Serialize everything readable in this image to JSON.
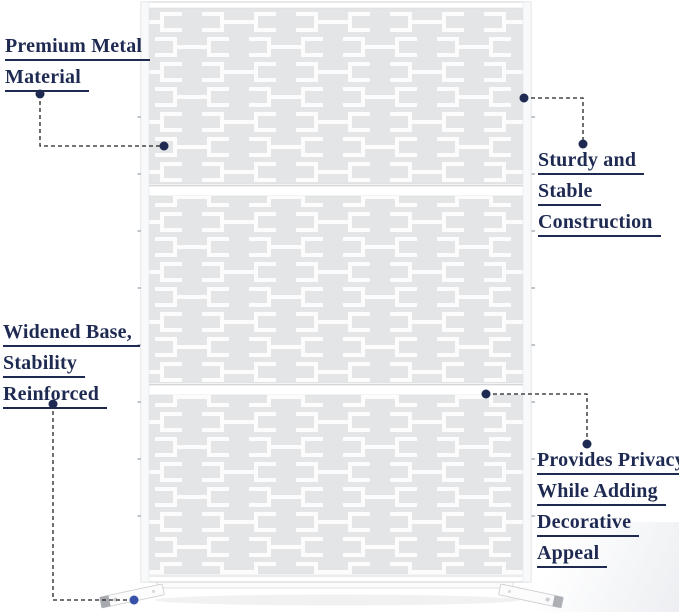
{
  "figure": {
    "subject": "white decorative metal privacy screen with laser-cut bracket pattern, three panels, widened feet",
    "panel_count": "3"
  },
  "callouts": [
    {
      "id": "premium-metal",
      "lines": [
        "Premium Metal",
        "Material"
      ]
    },
    {
      "id": "sturdy",
      "lines": [
        "Sturdy and",
        "Stable",
        "Construction"
      ]
    },
    {
      "id": "widened-base",
      "lines": [
        "Widened Base,",
        "Stability",
        "Reinforced"
      ]
    },
    {
      "id": "privacy-appeal",
      "lines": [
        "Provides Privacy",
        "While Adding",
        "Decorative",
        "Appeal"
      ]
    }
  ],
  "colors": {
    "label_text": "#1e2a52",
    "underline": "#1e2a52",
    "connector_line": "#222222",
    "connector_dot": "#1e2a52",
    "foot_dot": "#3552a8",
    "panel_gray": "#e4e5e7",
    "pattern_cutout": "#fcfcfd",
    "frame_white": "#ffffff",
    "frame_edge": "#d2d3d6",
    "background": "#ffffff"
  }
}
